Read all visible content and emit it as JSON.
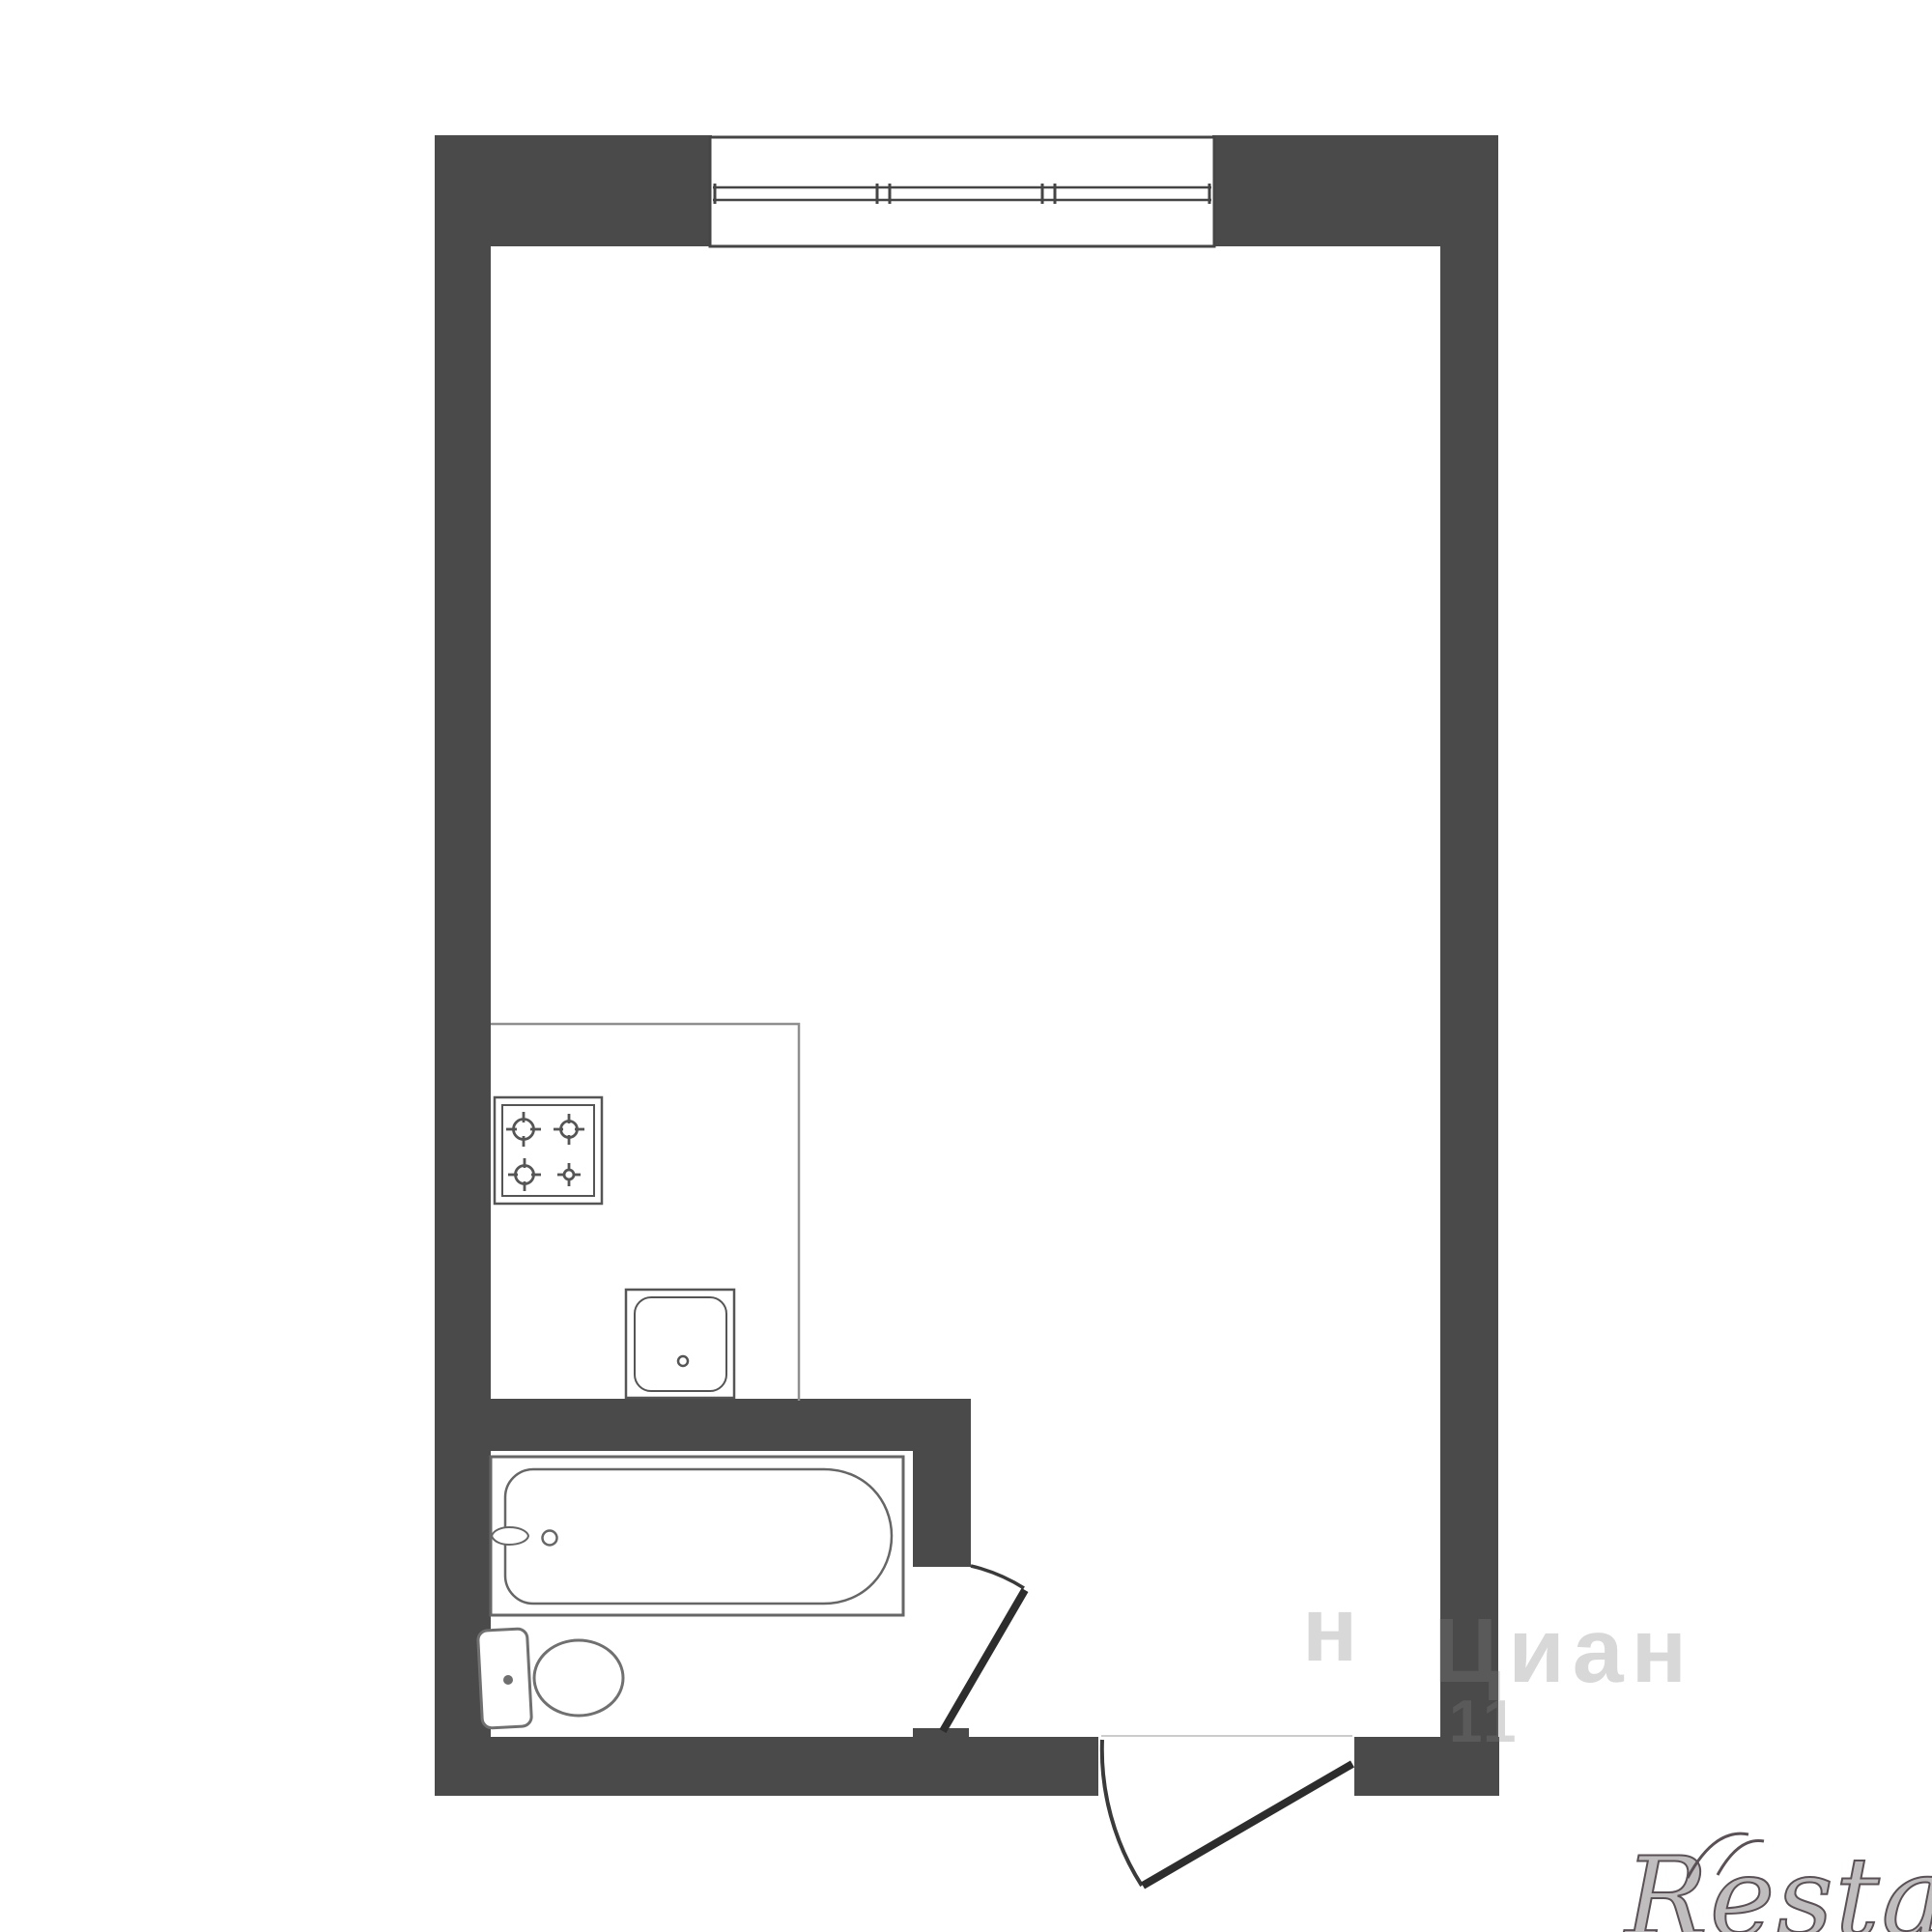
{
  "plan": {
    "type": "studio-apartment-floor-plan",
    "colors": {
      "wall": "#4a4a4a",
      "background": "#ffffff",
      "fixture_line": "#666666",
      "appliance_line": "#555555",
      "door_leaf": "#2d2d2d",
      "door_arc": "#3a3a3a",
      "counter_line": "#8f8f8f",
      "window_frame": "#454545",
      "threshold_line": "#cccccc",
      "ghost_watermark": "#7f7f7f",
      "brand_watermark": "#5a5156"
    },
    "elements": {
      "window": "window-3-panes",
      "kitchen_counter": "kitchen-counter-outline",
      "stove": "stove-4-burners",
      "sink": "kitchen-sink",
      "bathtub": "bathtub-with-faucet",
      "toilet": "toilet-with-tank",
      "bathroom_door": "bathroom-door-swing",
      "entrance_door": "entrance-door-swing"
    }
  },
  "watermarks": {
    "ghost_fragment": "н",
    "ghost_title": "Циан",
    "ghost_number": "11",
    "brand": "Restate"
  }
}
